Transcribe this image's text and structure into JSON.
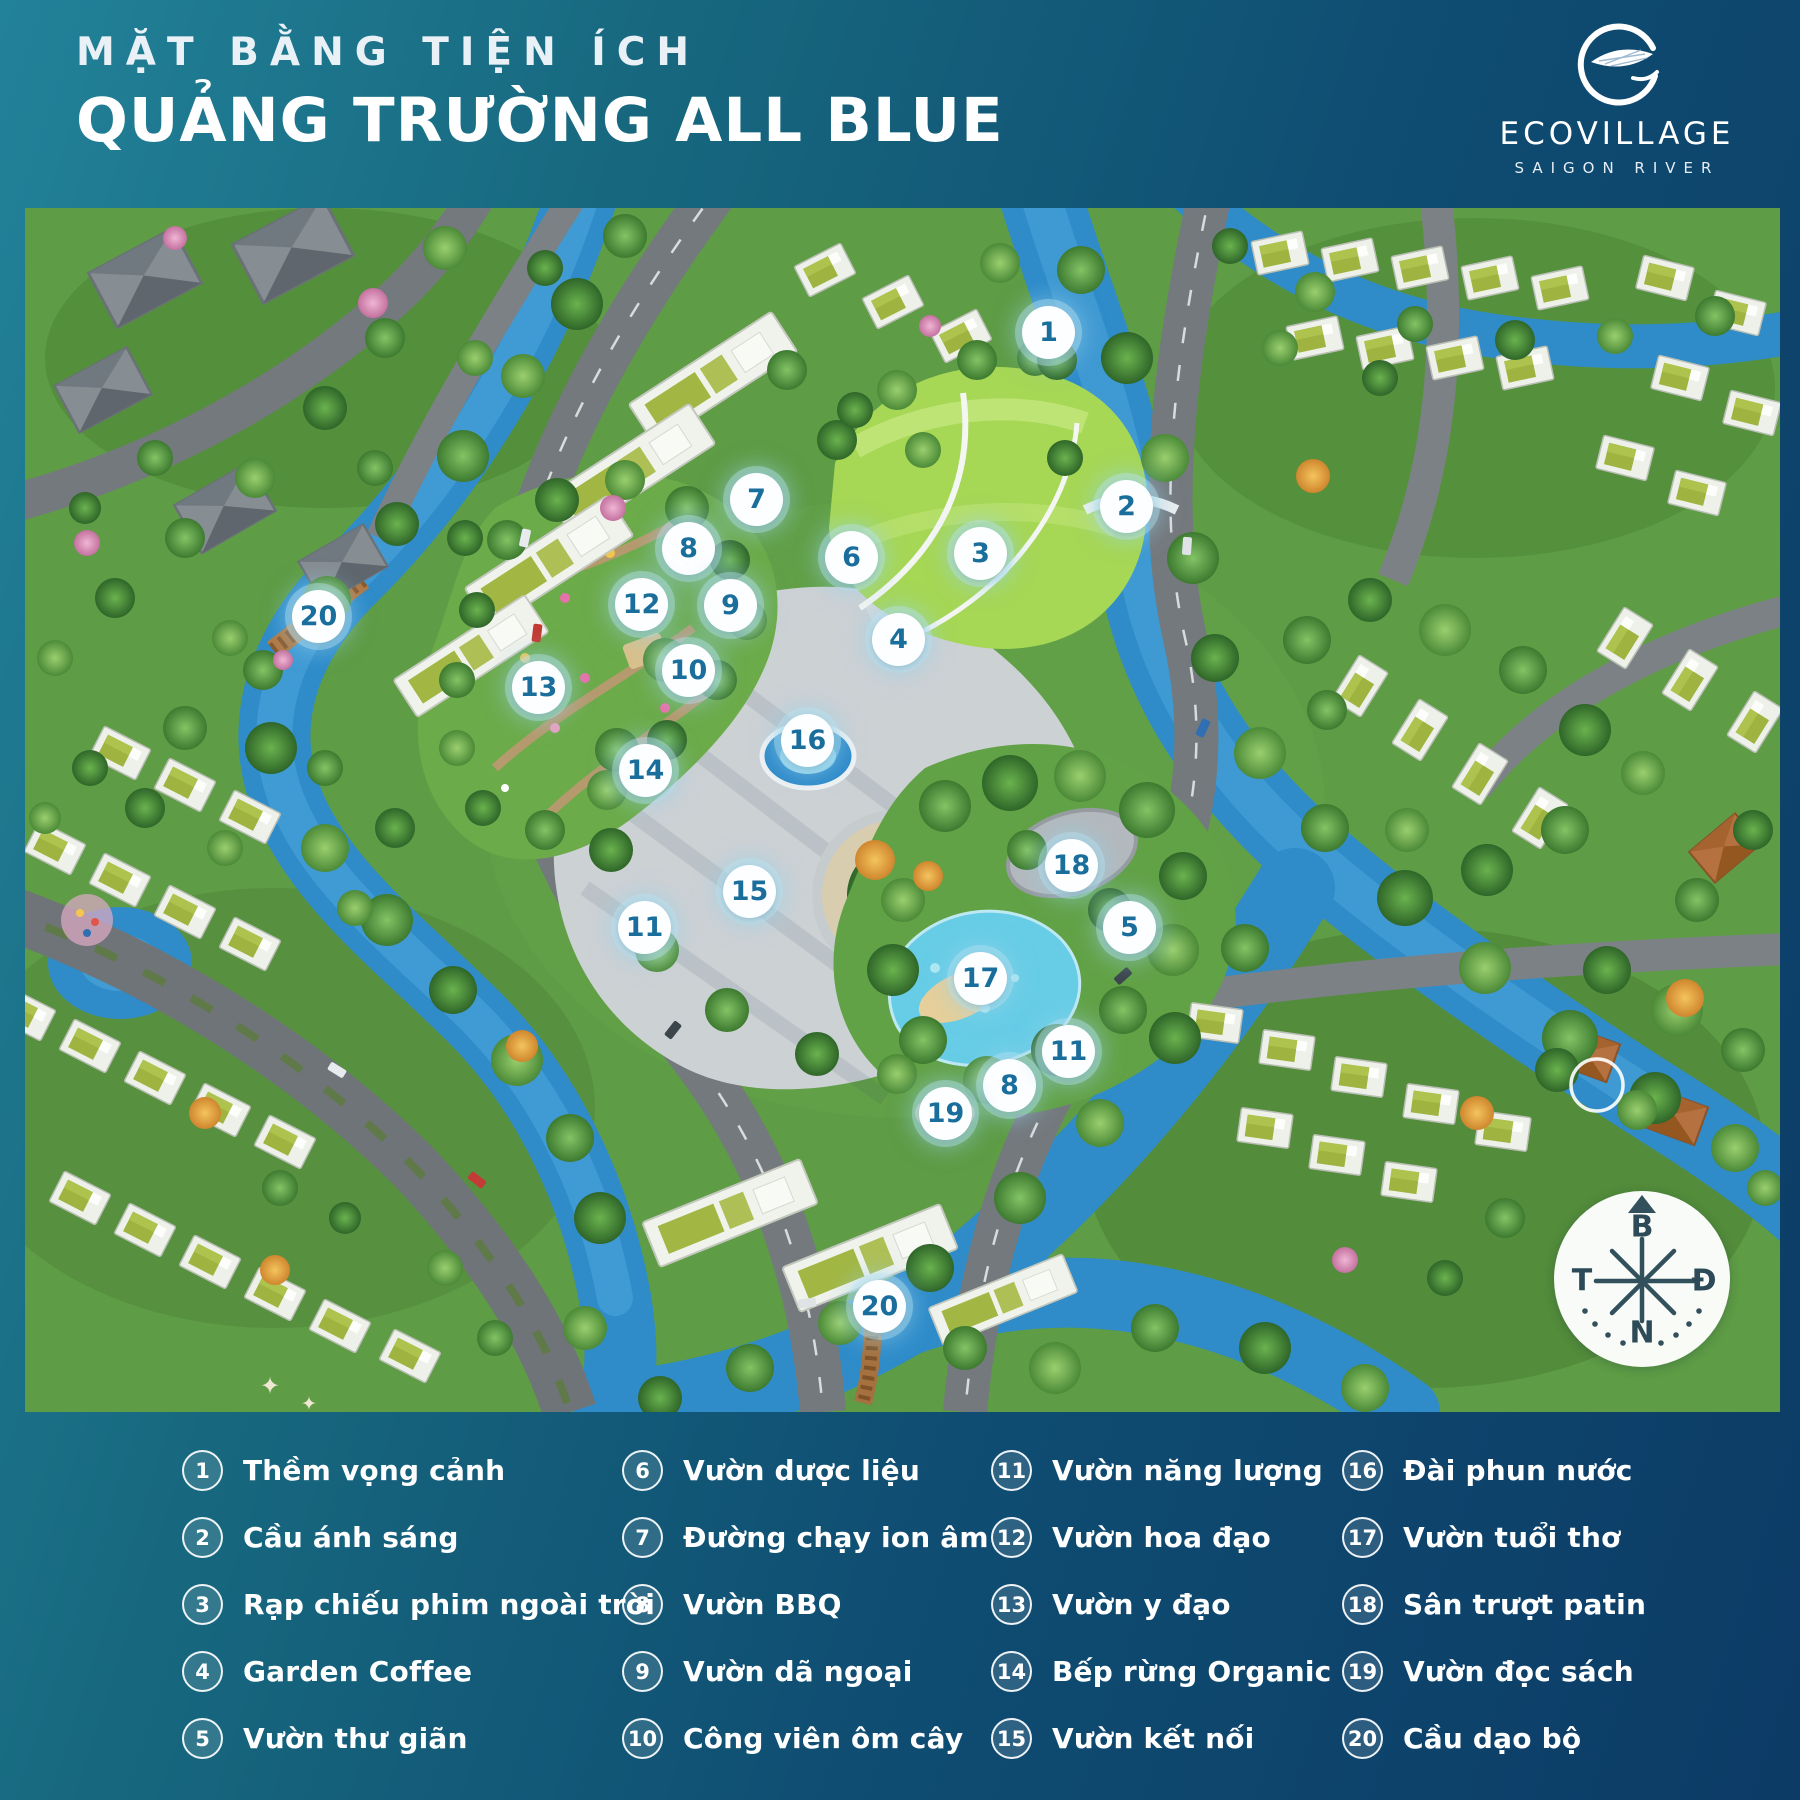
{
  "header": {
    "title_line1": "MẶT BẰNG TIỆN ÍCH",
    "title_line2": "QUẢNG TRƯỜNG ALL BLUE"
  },
  "logo": {
    "brand": "ECOVILLAGE",
    "tagline": "SAIGON RIVER"
  },
  "compass": {
    "north_label": "B",
    "east_label": "Đ",
    "south_label": "N",
    "west_label": "T"
  },
  "colors": {
    "marker_number": "#1a6e9c",
    "legend_text": "#ffffff",
    "background_teal": "#228299",
    "background_navy": "#0c3b66"
  },
  "map": {
    "markers": [
      {
        "num": "1",
        "x": 1049,
        "y": 333
      },
      {
        "num": "2",
        "x": 1127,
        "y": 507
      },
      {
        "num": "3",
        "x": 981,
        "y": 554
      },
      {
        "num": "4",
        "x": 899,
        "y": 640
      },
      {
        "num": "5",
        "x": 1130,
        "y": 928
      },
      {
        "num": "6",
        "x": 852,
        "y": 558
      },
      {
        "num": "7",
        "x": 757,
        "y": 500
      },
      {
        "num": "8",
        "x": 689,
        "y": 549
      },
      {
        "num": "8",
        "x": 1010,
        "y": 1086
      },
      {
        "num": "9",
        "x": 731,
        "y": 606
      },
      {
        "num": "10",
        "x": 689,
        "y": 671
      },
      {
        "num": "11",
        "x": 645,
        "y": 928
      },
      {
        "num": "11",
        "x": 1069,
        "y": 1052
      },
      {
        "num": "12",
        "x": 642,
        "y": 605
      },
      {
        "num": "13",
        "x": 539,
        "y": 688
      },
      {
        "num": "14",
        "x": 646,
        "y": 771
      },
      {
        "num": "15",
        "x": 750,
        "y": 892
      },
      {
        "num": "16",
        "x": 808,
        "y": 741
      },
      {
        "num": "17",
        "x": 981,
        "y": 979
      },
      {
        "num": "18",
        "x": 1072,
        "y": 866
      },
      {
        "num": "19",
        "x": 946,
        "y": 1114
      },
      {
        "num": "20",
        "x": 319,
        "y": 617
      },
      {
        "num": "20",
        "x": 880,
        "y": 1307
      }
    ]
  },
  "legend": {
    "columns": [
      [
        {
          "num": "1",
          "label": "Thềm vọng cảnh"
        },
        {
          "num": "2",
          "label": "Cầu ánh sáng"
        },
        {
          "num": "3",
          "label": "Rạp chiếu phim ngoài trời"
        },
        {
          "num": "4",
          "label": "Garden Coffee"
        },
        {
          "num": "5",
          "label": "Vườn thư giãn"
        }
      ],
      [
        {
          "num": "6",
          "label": "Vườn dược liệu"
        },
        {
          "num": "7",
          "label": "Đường chạy ion âm"
        },
        {
          "num": "8",
          "label": "Vườn BBQ"
        },
        {
          "num": "9",
          "label": "Vườn dã ngoại"
        },
        {
          "num": "10",
          "label": "Công viên ôm cây"
        }
      ],
      [
        {
          "num": "11",
          "label": "Vườn năng lượng"
        },
        {
          "num": "12",
          "label": "Vườn hoa đạo"
        },
        {
          "num": "13",
          "label": "Vườn y đạo"
        },
        {
          "num": "14",
          "label": "Bếp rừng Organic"
        },
        {
          "num": "15",
          "label": "Vườn kết nối"
        }
      ],
      [
        {
          "num": "16",
          "label": "Đài phun nước"
        },
        {
          "num": "17",
          "label": "Vườn tuổi thơ"
        },
        {
          "num": "18",
          "label": "Sân trượt patin"
        },
        {
          "num": "19",
          "label": "Vườn đọc sách"
        },
        {
          "num": "20",
          "label": "Cầu dạo bộ"
        }
      ]
    ]
  }
}
